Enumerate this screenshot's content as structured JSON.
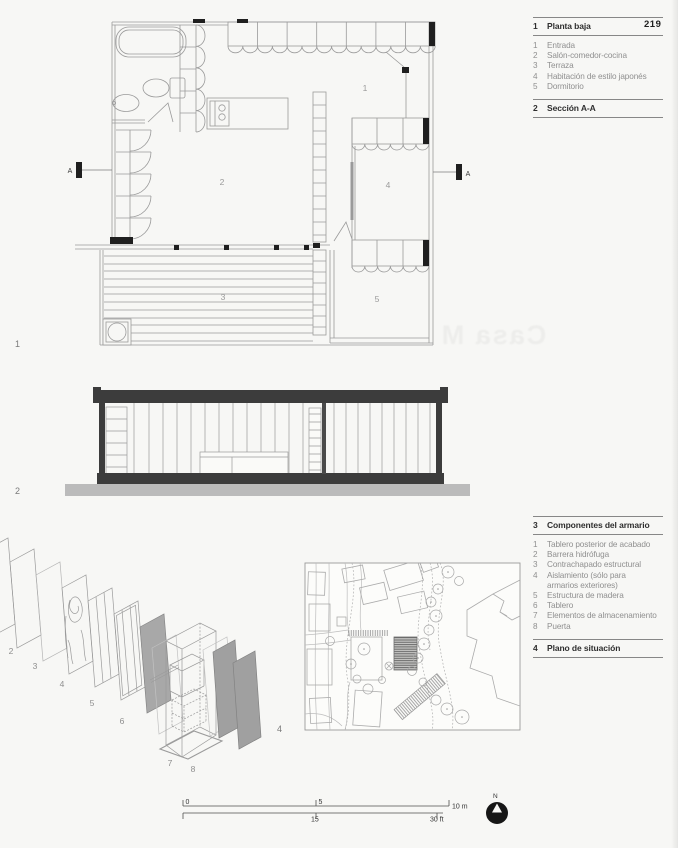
{
  "page": {
    "number": "219",
    "ghost_text": "Casa M"
  },
  "colors": {
    "slab": "#3c3c3c",
    "ground": "#bbbbbb",
    "panel_gray": "#a3a3a3",
    "text_gray": "#8f8f8f"
  },
  "figures": {
    "plan_no": "1",
    "section_no": "2",
    "site_no": "4"
  },
  "legend_plan": {
    "num": "1",
    "title": "Planta baja",
    "items": [
      {
        "num": "1",
        "label": "Entrada"
      },
      {
        "num": "2",
        "label": "Salón-comedor-cocina"
      },
      {
        "num": "3",
        "label": "Terraza"
      },
      {
        "num": "4",
        "label": "Habitación de estilo japonés"
      },
      {
        "num": "5",
        "label": "Dormitorio"
      }
    ]
  },
  "legend_section": {
    "num": "2",
    "title": "Sección A-A"
  },
  "legend_cabinet": {
    "num": "3",
    "title": "Componentes del armario",
    "items": [
      {
        "num": "1",
        "label": "Tablero posterior de acabado"
      },
      {
        "num": "2",
        "label": "Barrera hidrófuga"
      },
      {
        "num": "3",
        "label": "Contrachapado estructural"
      },
      {
        "num": "4",
        "label": "Aislamiento (sólo para"
      },
      {
        "num": "",
        "label": "armarios exteriores)"
      },
      {
        "num": "5",
        "label": "Estructura de madera"
      },
      {
        "num": "6",
        "label": "Tablero"
      },
      {
        "num": "7",
        "label": "Elementos de almacenamiento"
      },
      {
        "num": "8",
        "label": "Puerta"
      }
    ]
  },
  "legend_site": {
    "num": "4",
    "title": "Plano de situación"
  },
  "plan_labels": {
    "r1": "1",
    "r2": "2",
    "r3": "3",
    "r4": "4",
    "r5": "5",
    "section_a_left": "A",
    "section_a_right": "A"
  },
  "axon_labels": {
    "p2": "2",
    "p3": "3",
    "p4": "4",
    "p5": "5",
    "p6": "6",
    "p7": "7",
    "p8": "8"
  },
  "scale": {
    "m0": "0",
    "m5": "5",
    "m10": "10 m",
    "ft15": "15",
    "ft30": "30 ft"
  },
  "compass": {
    "n": "N"
  }
}
